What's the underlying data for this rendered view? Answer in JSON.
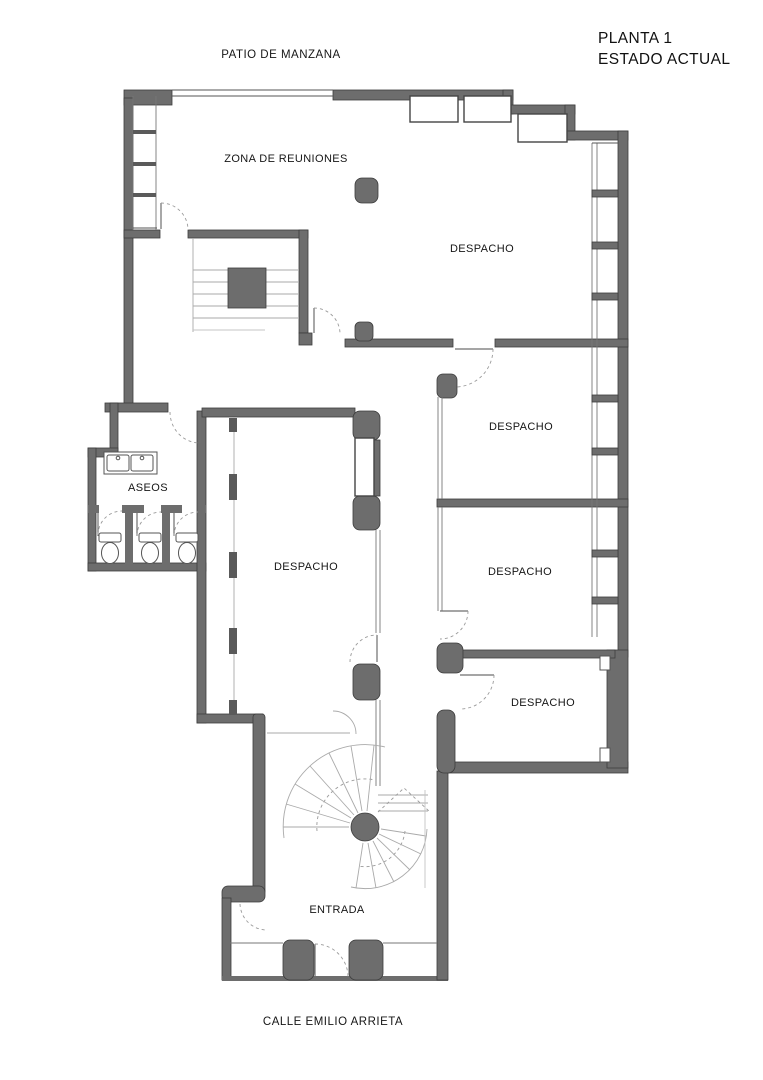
{
  "title": {
    "line1": "PLANTA 1",
    "line2": "ESTADO ACTUAL"
  },
  "context": {
    "top_label": "PATIO DE MANZANA",
    "bottom_label": "CALLE EMILIO ARRIETA"
  },
  "rooms": [
    {
      "name": "zona-de-reuniones",
      "label": "ZONA DE REUNIONES",
      "x": 286,
      "y": 159
    },
    {
      "name": "despacho-norte",
      "label": "DESPACHO",
      "x": 482,
      "y": 249
    },
    {
      "name": "despacho-este-1",
      "label": "DESPACHO",
      "x": 521,
      "y": 427
    },
    {
      "name": "despacho-central",
      "label": "DESPACHO",
      "x": 306,
      "y": 567
    },
    {
      "name": "despacho-este-2",
      "label": "DESPACHO",
      "x": 520,
      "y": 572
    },
    {
      "name": "despacho-sureste",
      "label": "DESPACHO",
      "x": 543,
      "y": 703
    },
    {
      "name": "aseos",
      "label": "ASEOS",
      "x": 148,
      "y": 488
    },
    {
      "name": "entrada",
      "label": "ENTRADA",
      "x": 337,
      "y": 910
    }
  ],
  "colors": {
    "wall": "#6d6d6d",
    "wall_edge": "#3c3c3c",
    "thin_line": "#555555",
    "light_line": "#aaaaaa",
    "background": "#ffffff"
  }
}
